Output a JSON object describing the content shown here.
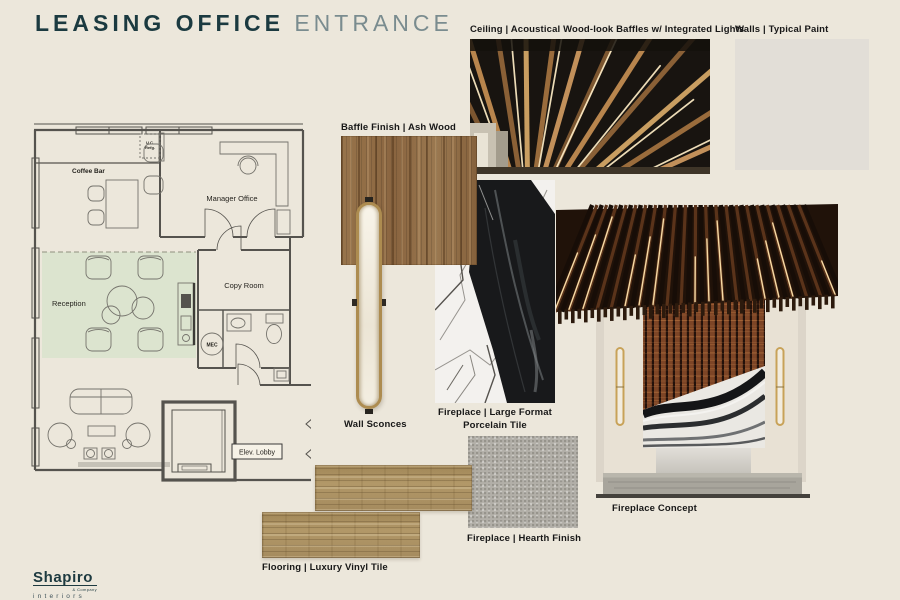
{
  "page": {
    "title_primary": "LEASING OFFICE",
    "title_secondary": "ENTRANCE"
  },
  "labels": {
    "ceiling": "Ceiling | Acoustical Wood-look Baffles w/ Integrated Lights",
    "walls": "Walls | Typical Paint",
    "baffle_finish": "Baffle Finish | Ash Wood",
    "wall_sconces": "Wall Sconces",
    "fireplace_tile_line1": "Fireplace | Large Format",
    "fireplace_tile_line2": "Porcelain Tile",
    "fireplace_concept": "Fireplace Concept",
    "fireplace_hearth": "Fireplace | Hearth Finish",
    "flooring": "Flooring | Luxury Vinyl Tile"
  },
  "floor_plan": {
    "reception": "Reception",
    "manager_office": "Manager Office",
    "copy_room": "Copy Room",
    "coffee_bar": "Coffee Bar",
    "elev_lobby": "Elev. Lobby",
    "mec": "MEC",
    "uc_line1": "U.C.",
    "uc_line2": "Refg.",
    "highlight_color": "#dce4cf"
  },
  "brand": {
    "name": "Shapiro",
    "company": "& Company",
    "division": "interiors"
  },
  "colors": {
    "background": "#ece7db",
    "title_primary": "#1b3a40",
    "title_secondary": "#7a8c8f",
    "paint_swatch": "#e2ded7",
    "ash_wood": "#8f6a42",
    "oak_lvt": "#ab9164",
    "hearth_concrete": "#b2afa8",
    "sconce_brass": "#ad8c50",
    "marble_black": "#18191b",
    "slat_rust": "#7d4526"
  }
}
